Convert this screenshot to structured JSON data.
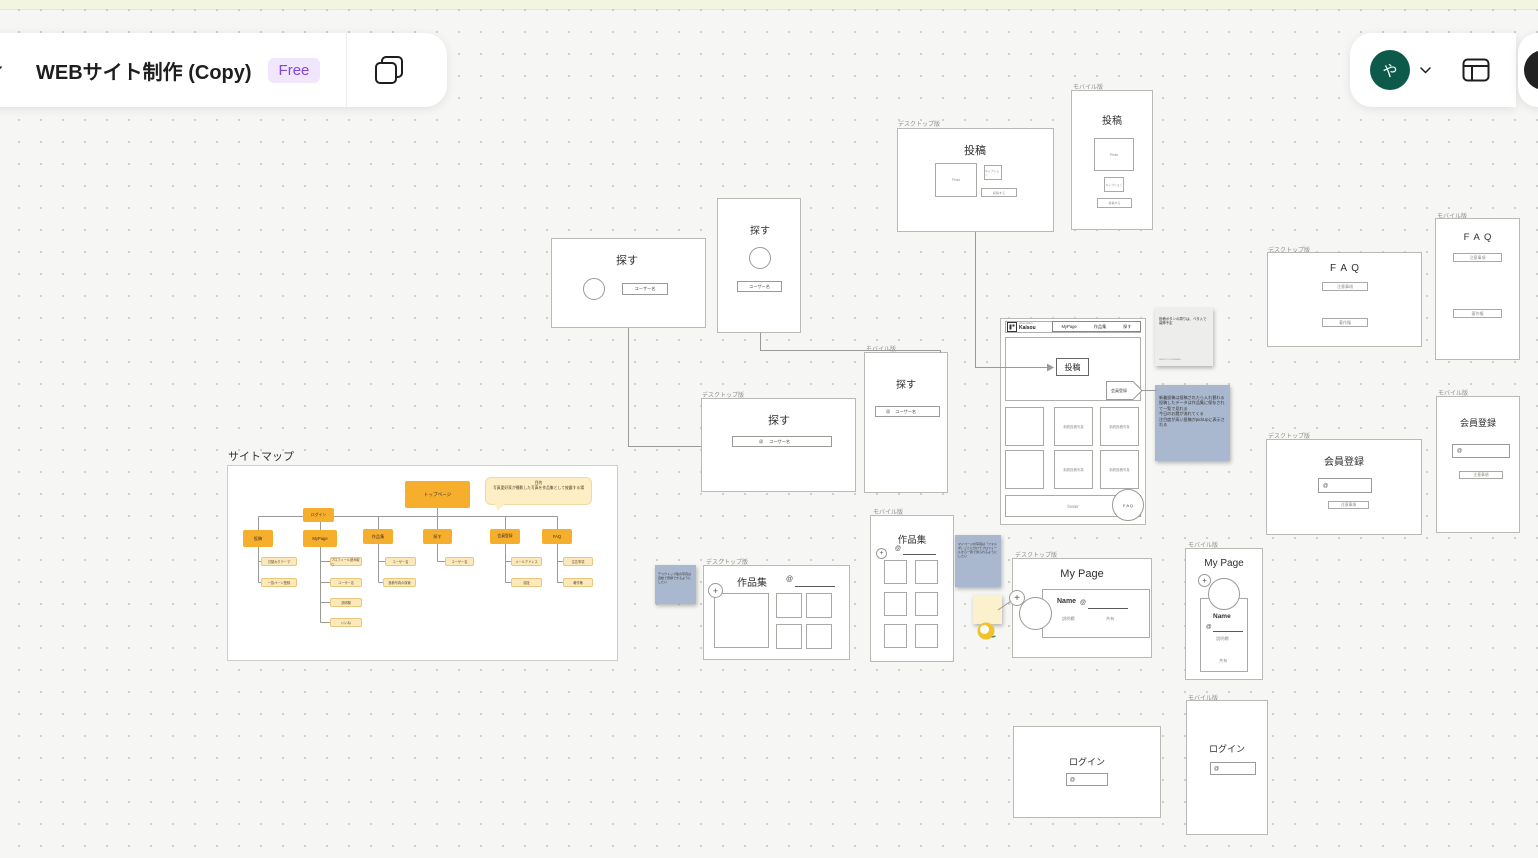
{
  "topbar": {
    "title": "WEBサイト制作 (Copy)",
    "badge": "Free",
    "avatar": "や"
  },
  "frame_labels": {
    "desktop": "デスクトップ版",
    "mobile": "モバイル版"
  },
  "icons": {
    "plus": "+"
  },
  "search": {
    "title": "探す",
    "username": "ユーザー名",
    "at": "@"
  },
  "post": {
    "title": "投稿",
    "photo": "Photo",
    "caption": "キャプション",
    "submit": "投稿する"
  },
  "home": {
    "logo_tag": "photo gallery",
    "logo": "Kaisou",
    "nav": {
      "mypage": "MyPage",
      "works": "作品集",
      "search": "探す"
    },
    "post_button": "投稿",
    "register": "会員登録",
    "new_photo": "新着投稿写真",
    "footer": "footer",
    "faq": "F A Q"
  },
  "faq": {
    "title": "F A Q",
    "notes": "注意事項",
    "copyright": "著作権"
  },
  "register": {
    "title": "会員登録",
    "at": "@",
    "notes": "注意事項"
  },
  "works": {
    "title": "作品集",
    "at": "@"
  },
  "mypage": {
    "title": "My Page",
    "name": "Name",
    "at": "@",
    "desc": "説明欄",
    "share": "共有"
  },
  "login": {
    "title": "ログイン",
    "at": "@"
  },
  "sitemap": {
    "heading": "サイトマップ",
    "top": "トップページ",
    "login": "ログイン",
    "bubble_title": "目的",
    "bubble_body": "写真愛好家が撮影した写真を作品集として披露する場",
    "nodes": {
      "post": "投稿",
      "mypage": "MyPage",
      "works": "作品集",
      "search": "探す",
      "register": "会員登録",
      "faq": "FAQ"
    },
    "leaves": {
      "post1": "日替わりテーマ",
      "post2": "一覧ページ登録",
      "mypage1": "プロフィール読み取り",
      "mypage2": "ユーザー名",
      "mypage3": "説明欄",
      "mypage4": "いいね",
      "works1": "ユーザー名",
      "works2": "投稿写真の保管",
      "search1": "ユーザー名",
      "register1": "メールアドレス",
      "register2": "認証",
      "faq1": "注意事項",
      "faq2": "著作権"
    }
  },
  "stickies": {
    "gray_text": "投稿ボタンの周りは、ベタ入で装飾予定",
    "gray_author": "SACHITO KURIHARA",
    "blue_post": "新着投稿は投稿されたら入れ替わる\n投稿したデータは作品集に保存されて一覧で見れる\n今日のお題が流れてくる\n注目度が高い投稿がpickUpに表示される",
    "blue_works": "デスクトップ版の写真は自動で登録できるようにしたい",
    "blue_mypage": "マイページの写真は「フォルダ」ごとに分けてプロフィールから一覧で見られるようにしたい"
  }
}
